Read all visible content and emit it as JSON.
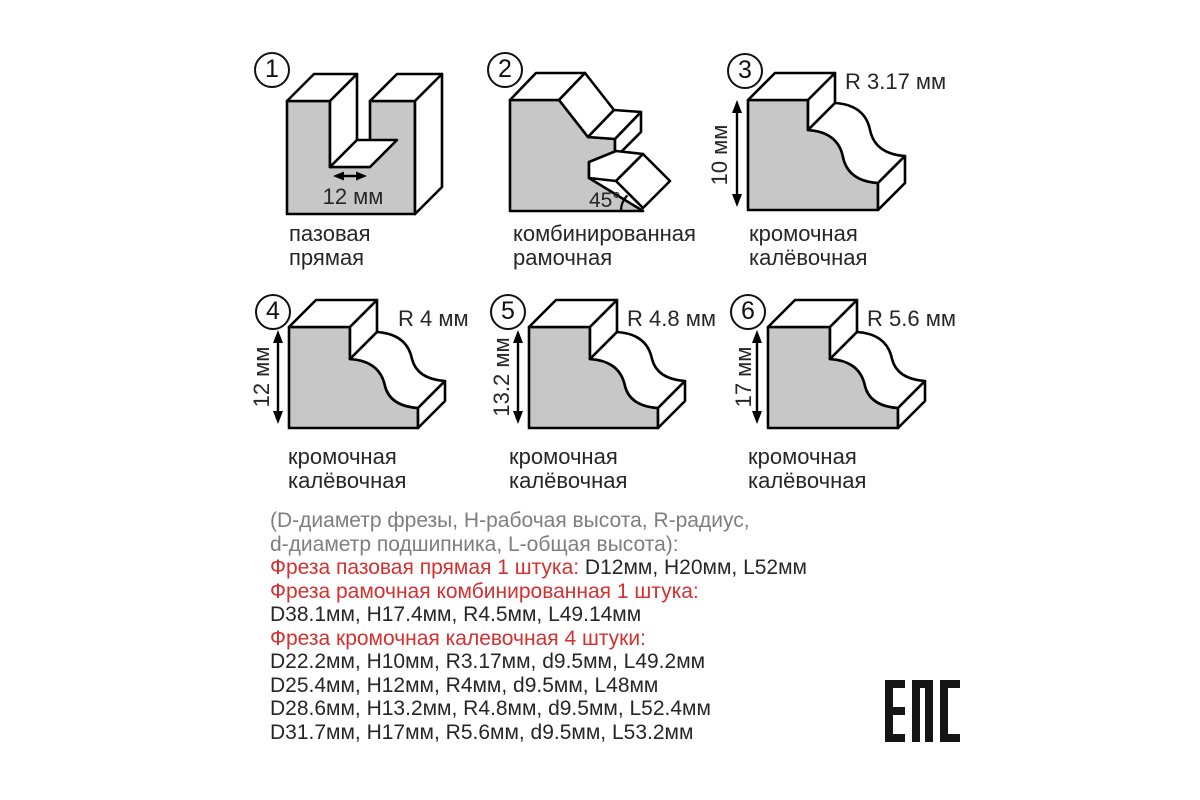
{
  "figures": [
    {
      "number": "1",
      "caption_line1": "пазовая",
      "caption_line2": "прямая",
      "width_label": "12 мм"
    },
    {
      "number": "2",
      "caption_line1": "комбинированная",
      "caption_line2": "рамочная",
      "angle_label": "45°"
    },
    {
      "number": "3",
      "caption_line1": "кромочная",
      "caption_line2": "калёвочная",
      "radius_label": "R 3.17 мм",
      "height_label": "10 мм"
    },
    {
      "number": "4",
      "caption_line1": "кромочная",
      "caption_line2": "калёвочная",
      "radius_label": "R 4 мм",
      "height_label": "12 мм"
    },
    {
      "number": "5",
      "caption_line1": "кромочная",
      "caption_line2": "калёвочная",
      "radius_label": "R 4.8 мм",
      "height_label": "13.2 мм"
    },
    {
      "number": "6",
      "caption_line1": "кромочная",
      "caption_line2": "калёвочная",
      "radius_label": "R 5.6 мм",
      "height_label": "17 мм"
    }
  ],
  "specs": {
    "lines": [
      {
        "gray": "(D-диаметр фрезы, H-рабочая высота, R-радиус,"
      },
      {
        "gray": "d-диаметр подшипника, L-общая высота):"
      },
      {
        "red": "Фреза пазовая прямая 1 штука:",
        "black": " D12мм, H20мм, L52мм"
      },
      {
        "red": "Фреза рамочная комбинированная 1 штука:"
      },
      {
        "black": "D38.1мм, H17.4мм, R4.5мм, L49.14мм"
      },
      {
        "red": "Фреза кромочная калевочная 4 штуки:"
      },
      {
        "black": "D22.2мм, H10мм, R3.17мм, d9.5мм, L49.2мм"
      },
      {
        "black": "D25.4мм, H12мм, R4мм, d9.5мм, L48мм"
      },
      {
        "black": "D28.6мм, H13.2мм, R4.8мм, d9.5мм, L52.4мм"
      },
      {
        "black": "D31.7мм, H17мм, R5.6мм, d9.5мм, L53.2мм"
      }
    ]
  },
  "eac": {
    "mark": "EAC"
  },
  "colors": {
    "shape_fill": "#c7c7c7",
    "outline": "#000000",
    "accent_red": "#d3302f",
    "legend_gray": "#7e7e7e",
    "body_text": "#262626"
  }
}
